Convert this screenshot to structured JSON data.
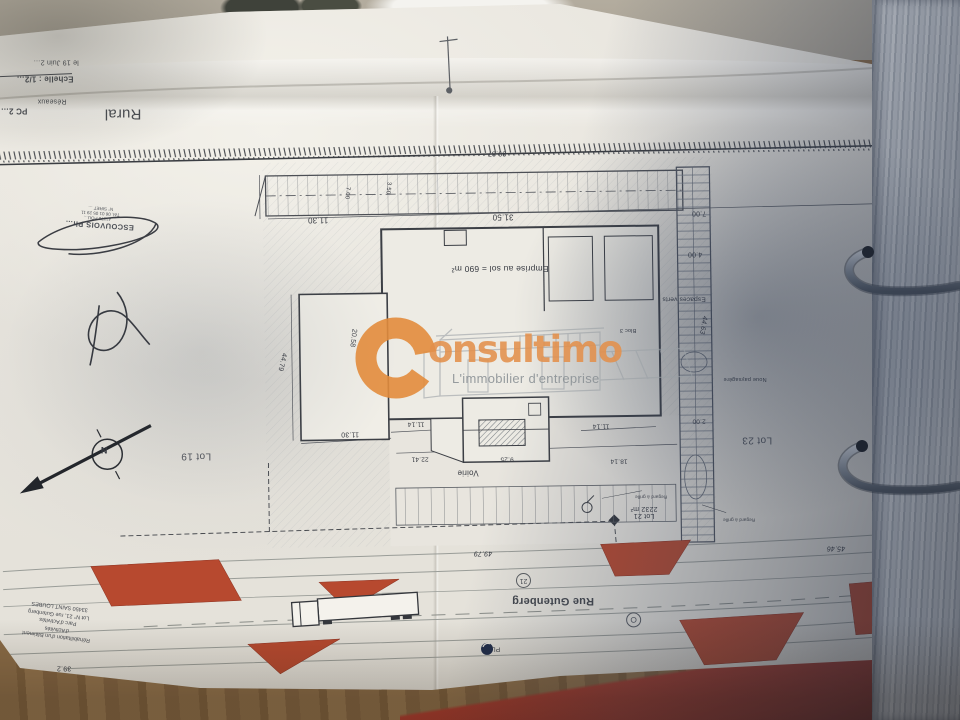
{
  "photo": {
    "paper_color": "#e8e5de",
    "wood_color": "#8a6b46",
    "binder_red": "#a93a2c",
    "island_red": "#b7492f",
    "shadow_blue": "#2e3a52"
  },
  "watermark": {
    "brand": "Consultimo",
    "brand_rest": "onsultimo",
    "tagline": "L'immobilier d'entreprise",
    "orange": "#e2904b",
    "gray": "#8d9499"
  },
  "title_block": {
    "date": "le 19 Juin 2…",
    "scale": "Echelle : 1/2…",
    "networks": "Réseaux",
    "pc": "PC 2…",
    "zone": "Rural"
  },
  "stamp": {
    "name": "ESCOUVOIS Ph…",
    "address": "… 41170 POU…",
    "phone": "Tél. 06 01 05 29 11",
    "siret": "N° SIRET …"
  },
  "footer_block": {
    "line1": "Réhabilitation d'un Bâtiment d'Activités",
    "line2": "Parc d'Activités",
    "line3": "Lot N° 21, rue Gutenberg",
    "line4": "33450 SAINT LOUBES"
  },
  "plan": {
    "compass_n": "N",
    "street": {
      "name": "Rue Gutenberg",
      "marker": "21",
      "truck_badge": "PL"
    },
    "lots": {
      "lot19": "Lot 19",
      "lot21": "Lot 21",
      "lot21_area": "2232 m²",
      "lot23": "Lot 23"
    },
    "building": {
      "emprise": "Emprise au sol = 690 m²",
      "bloc": "Bloc 3",
      "voirie": "Voirie"
    },
    "green": {
      "espaces_verts": "Espaces verts",
      "noue": "Noue paysagère"
    },
    "notes": {
      "regard": "Regard à grille"
    },
    "dims": {
      "boundary": "89.87",
      "parking": "31.50",
      "d1130_top": "11.30",
      "d700_left": "7.00",
      "d350": "3.50",
      "d700_right": "7.00",
      "d400": "4.00",
      "d4463": "44.63",
      "d200": "2.00",
      "d2058": "20.58",
      "d4479": "44.79",
      "d1130_bot": "11.30",
      "d1114_a": "11.14",
      "d1114_b": "11.14",
      "d2241": "22.41",
      "d925": "9.25",
      "d1814": "18.14",
      "d4979": "49.79",
      "d4546": "45.46",
      "d392": "39.2"
    }
  }
}
